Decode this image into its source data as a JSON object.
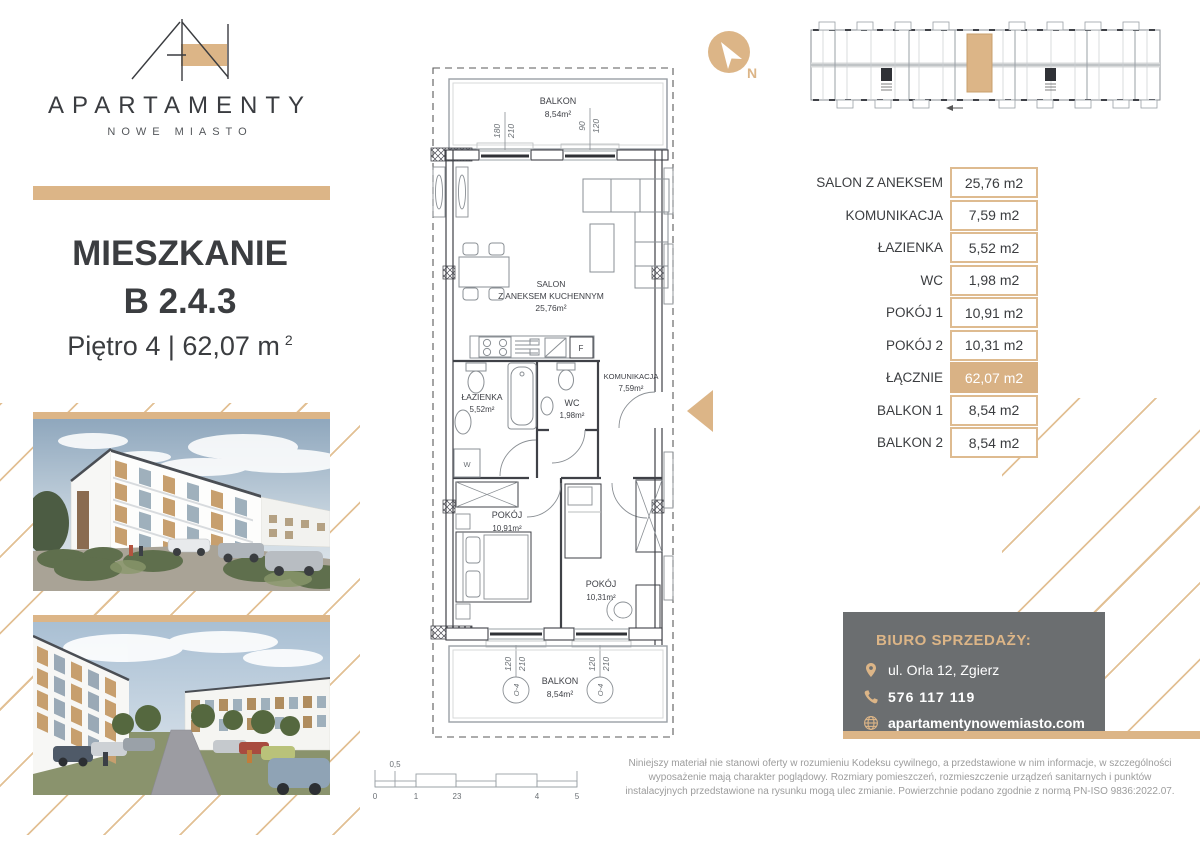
{
  "brand": {
    "name": "APARTAMENTY",
    "subtitle": "NOWE MIASTO"
  },
  "title": {
    "heading": "MIESZKANIE",
    "unit": "B 2.4.3",
    "floor": "Piętro 4 | 62,07 m",
    "area_sup": "2"
  },
  "compass": {
    "north": "N"
  },
  "areas_table": {
    "rows": [
      {
        "label": "SALON Z ANEKSEM",
        "value": "25,76 m2"
      },
      {
        "label": "KOMUNIKACJA",
        "value": "7,59 m2"
      },
      {
        "label": "ŁAZIENKA",
        "value": "5,52 m2"
      },
      {
        "label": "WC",
        "value": "1,98 m2"
      },
      {
        "label": "POKÓJ 1",
        "value": "10,91 m2"
      },
      {
        "label": "POKÓJ 2",
        "value": "10,31 m2"
      },
      {
        "label": "ŁĄCZNIE",
        "value": "62,07 m2"
      },
      {
        "label": "BALKON 1",
        "value": "8,54 m2"
      },
      {
        "label": "BALKON 2",
        "value": "8,54 m2"
      }
    ]
  },
  "plan": {
    "balcony_top": {
      "name": "BALKON",
      "area": "8,54m²"
    },
    "salon": {
      "line1": "SALON",
      "line2": "Z ANEKSEM KUCHENNYM",
      "area": "25,76m²"
    },
    "lazienka": {
      "name": "ŁAZIENKA",
      "area": "5,52m²"
    },
    "wc": {
      "name": "WC",
      "area": "1,98m²"
    },
    "komunikacja": {
      "name": "KOMUNIKACJA",
      "area": "7,59m²"
    },
    "pokoj1": {
      "name": "POKÓJ",
      "area": "10,91m²"
    },
    "pokoj2": {
      "name": "POKÓJ",
      "area": "10,31m²"
    },
    "balcony_bottom": {
      "name": "BALKON",
      "area": "8,54m²"
    },
    "washer": "W",
    "fridge": "F",
    "dims": {
      "door_top": [
        "180",
        "210"
      ],
      "window_top": [
        "90",
        "120"
      ],
      "window_bottom": [
        "120",
        "210"
      ]
    },
    "window_mark": "O-4"
  },
  "scalebar": {
    "half": "0,5",
    "labels": [
      "0",
      "1",
      "23",
      "4",
      "5"
    ]
  },
  "contact": {
    "heading": "BIURO SPRZEDAŻY:",
    "address": "ul. Orla 12, Zgierz",
    "phone": "576 117 119",
    "website": "apartamentynowemiasto.com"
  },
  "disclaimer": "Niniejszy materiał nie stanowi oferty w rozumieniu Kodeksu cywilnego, a przedstawione w nim informacje, w szczególności wyposażenie mają charakter poglądowy. Rozmiary pomieszczeń, rozmieszczenie urządzeń sanitarnych i punktów instalacyjnych przedstawione na rysunku mogą ulec zmianie. Powierzchnie podano zgodnie z normą PN-ISO 9836:2022.07.",
  "colors": {
    "accent": "#DCB587",
    "contact_bg": "#6B6E70"
  }
}
